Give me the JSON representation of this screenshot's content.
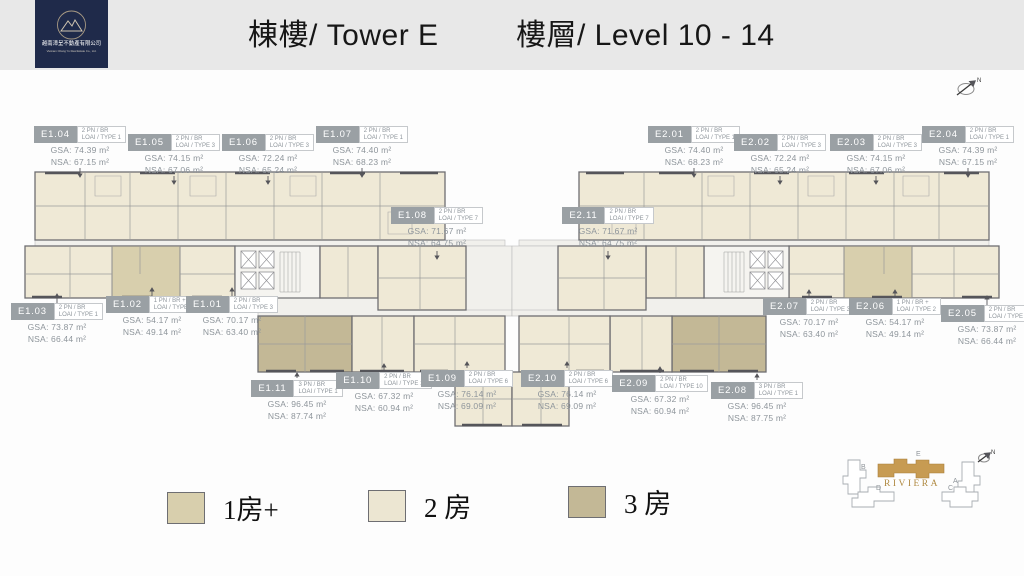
{
  "header": {
    "logo": {
      "company_zh": "越南漳呈不動產有限公司",
      "company_en": "Vietnam Chang Yu Real Estate Co., Ltd."
    },
    "title_tower": "棟樓/ Tower E",
    "title_level": "樓層/ Level 10 - 14"
  },
  "compass": {
    "label": "N"
  },
  "units": [
    {
      "id": "E1.01",
      "bed": "2 PN / BR",
      "type": "LOAI / TYPE 3",
      "gsa": "GSA: 70.17 m²",
      "nsa": "NSA: 63.40 m²"
    },
    {
      "id": "E1.02",
      "bed": "1 PN / BR +",
      "type": "LOAI / TYPE 2",
      "gsa": "GSA: 54.17 m²",
      "nsa": "NSA: 49.14 m²"
    },
    {
      "id": "E1.03",
      "bed": "2 PN / BR",
      "type": "LOAI / TYPE 1",
      "gsa": "GSA: 73.87 m²",
      "nsa": "NSA: 66.44 m²"
    },
    {
      "id": "E1.04",
      "bed": "2 PN / BR",
      "type": "LOAI / TYPE 1",
      "gsa": "GSA: 74.39 m²",
      "nsa": "NSA: 67.15 m²"
    },
    {
      "id": "E1.05",
      "bed": "2 PN / BR",
      "type": "LOAI / TYPE 3",
      "gsa": "GSA: 74.15 m²",
      "nsa": "NSA: 67.06 m²"
    },
    {
      "id": "E1.06",
      "bed": "2 PN / BR",
      "type": "LOAI / TYPE 3",
      "gsa": "GSA: 72.24 m²",
      "nsa": "NSA: 65.24 m²"
    },
    {
      "id": "E1.07",
      "bed": "2 PN / BR",
      "type": "LOAI / TYPE 1",
      "gsa": "GSA: 74.40 m²",
      "nsa": "NSA: 68.23 m²"
    },
    {
      "id": "E1.08",
      "bed": "2 PN / BR",
      "type": "LOAI / TYPE 7",
      "gsa": "GSA: 71.67 m²",
      "nsa": "NSA: 64.75 m²"
    },
    {
      "id": "E1.09",
      "bed": "2 PN / BR",
      "type": "LOAI / TYPE 6",
      "gsa": "GSA: 76.14 m²",
      "nsa": "NSA: 69.09 m²"
    },
    {
      "id": "E1.10",
      "bed": "2 PN / BR",
      "type": "LOAI / TYPE 10",
      "gsa": "GSA: 67.32 m²",
      "nsa": "NSA: 60.94 m²"
    },
    {
      "id": "E1.11",
      "bed": "3 PN / BR",
      "type": "LOAI / TYPE 1",
      "gsa": "GSA: 96.45 m²",
      "nsa": "NSA: 87.74 m²"
    },
    {
      "id": "E2.01",
      "bed": "2 PN / BR",
      "type": "LOAI / TYPE 1",
      "gsa": "GSA: 74.40 m²",
      "nsa": "NSA: 68.23 m²"
    },
    {
      "id": "E2.02",
      "bed": "2 PN / BR",
      "type": "LOAI / TYPE 3",
      "gsa": "GSA: 72.24 m²",
      "nsa": "NSA: 65.24 m²"
    },
    {
      "id": "E2.03",
      "bed": "2 PN / BR",
      "type": "LOAI / TYPE 3",
      "gsa": "GSA: 74.15 m²",
      "nsa": "NSA: 67.06 m²"
    },
    {
      "id": "E2.04",
      "bed": "2 PN / BR",
      "type": "LOAI / TYPE 1",
      "gsa": "GSA: 74.39 m²",
      "nsa": "NSA: 67.15 m²"
    },
    {
      "id": "E2.05",
      "bed": "2 PN / BR",
      "type": "LOAI / TYPE 1",
      "gsa": "GSA: 73.87 m²",
      "nsa": "NSA: 66.44 m²"
    },
    {
      "id": "E2.06",
      "bed": "1 PN / BR +",
      "type": "LOAI / TYPE 2",
      "gsa": "GSA: 54.17 m²",
      "nsa": "NSA: 49.14 m²"
    },
    {
      "id": "E2.07",
      "bed": "2 PN / BR",
      "type": "LOAI / TYPE 3",
      "gsa": "GSA: 70.17 m²",
      "nsa": "NSA: 63.40 m²"
    },
    {
      "id": "E2.08",
      "bed": "3 PN / BR",
      "type": "LOAI / TYPE 1",
      "gsa": "GSA: 96.45 m²",
      "nsa": "NSA: 87.75 m²"
    },
    {
      "id": "E2.09",
      "bed": "2 PN / BR",
      "type": "LOAI / TYPE 10",
      "gsa": "GSA: 67.32 m²",
      "nsa": "NSA: 60.94 m²"
    },
    {
      "id": "E2.10",
      "bed": "2 PN / BR",
      "type": "LOAI / TYPE 6",
      "gsa": "GSA: 76.14 m²",
      "nsa": "NSA: 69.09 m²"
    },
    {
      "id": "E2.11",
      "bed": "2 PN / BR",
      "type": "LOAI / TYPE 7",
      "gsa": "GSA: 71.67 m²",
      "nsa": "NSA: 64.75 m²"
    }
  ],
  "legend": {
    "items": [
      {
        "label": "1房+",
        "color": "#d8cfad"
      },
      {
        "label": "2 房",
        "color": "#ece6d2"
      },
      {
        "label": "3 房",
        "color": "#c3b896"
      }
    ]
  },
  "minimap": {
    "project": "RIVIERA",
    "towers": [
      "B",
      "E",
      "A",
      "D",
      "C"
    ],
    "highlighted": "E",
    "compass_label": "N"
  },
  "colors": {
    "unit_1br": "#d8cfad",
    "unit_2br": "#efe9d6",
    "unit_3br": "#c3b896",
    "wall": "#6e6e72",
    "label_box": "#9aa0a4",
    "logo_navy": "#1f2a4a",
    "gold": "#c79b52"
  }
}
